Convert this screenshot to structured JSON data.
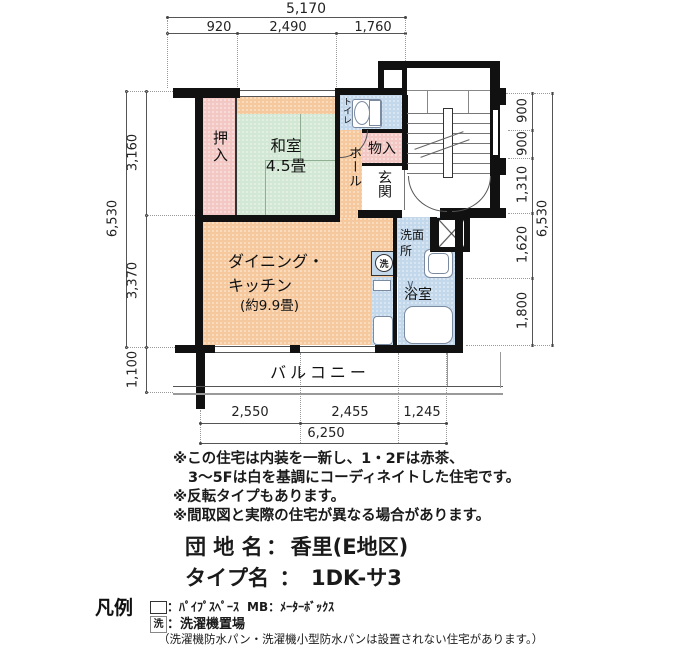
{
  "colors": {
    "wall": "#111111",
    "pink": "#f3c8c4",
    "green": "#d2e8d4",
    "orange": "#f5c89d",
    "blue": "#c4d8ec"
  },
  "dims": {
    "top": {
      "total": "5,170",
      "segments": [
        "920",
        "2,490",
        "1,760"
      ]
    },
    "bottom": {
      "total": "6,250",
      "segments": [
        "2,550",
        "2,455",
        "1,245"
      ]
    },
    "left": {
      "total": "6,530",
      "upper": "3,160",
      "lower": "3,370",
      "balcony": "1,100"
    },
    "right": {
      "total": "6,530",
      "segments": [
        "900",
        "900",
        "1,310",
        "1,620",
        "1,800"
      ]
    }
  },
  "rooms": {
    "oshiire": {
      "label": "押入"
    },
    "washitsu": {
      "label": "和室",
      "size": "4.5畳"
    },
    "toilet": {
      "label": "トイレ"
    },
    "monoire": {
      "label": "物入"
    },
    "genkan": {
      "label": "玄関"
    },
    "hall": {
      "label": "ホール"
    },
    "dk": {
      "line1": "ダイニング・",
      "line2": "キッチン",
      "size": "(約9.9畳)"
    },
    "senmenjo": {
      "line1": "洗面",
      "line2": "所"
    },
    "yokushitsu": {
      "label": "浴室"
    },
    "laundry": {
      "symbol": "洗"
    },
    "balcony": {
      "label": "バルコニー"
    }
  },
  "notes": {
    "line1": "※この住宅は内装を一新し、1・2Fは赤茶、",
    "line2": "3〜5Fは白を基調にコーディネイトした住宅です。",
    "line3": "※反転タイプもあります。",
    "line4": "※間取図と実際の住宅が異なる場合があります。"
  },
  "titles": {
    "estate_label": "団 地 名",
    "estate_sep": "：",
    "estate_value": "香里(E地区)",
    "type_label": "タイプ名",
    "type_sep": "：",
    "type_value": "1DK-サ3"
  },
  "legend": {
    "title": "凡例",
    "ps_text": "：ﾊﾟｲﾌﾟｽﾍﾟｰｽ",
    "mb_text": "MB：ﾒｰﾀｰﾎﾞｯｸｽ",
    "wash_symbol": "洗",
    "wash_text": "：洗濯機置場",
    "note": "（洗濯機防水パン・洗濯機小型防水パンは設置されない住宅があります。）"
  }
}
